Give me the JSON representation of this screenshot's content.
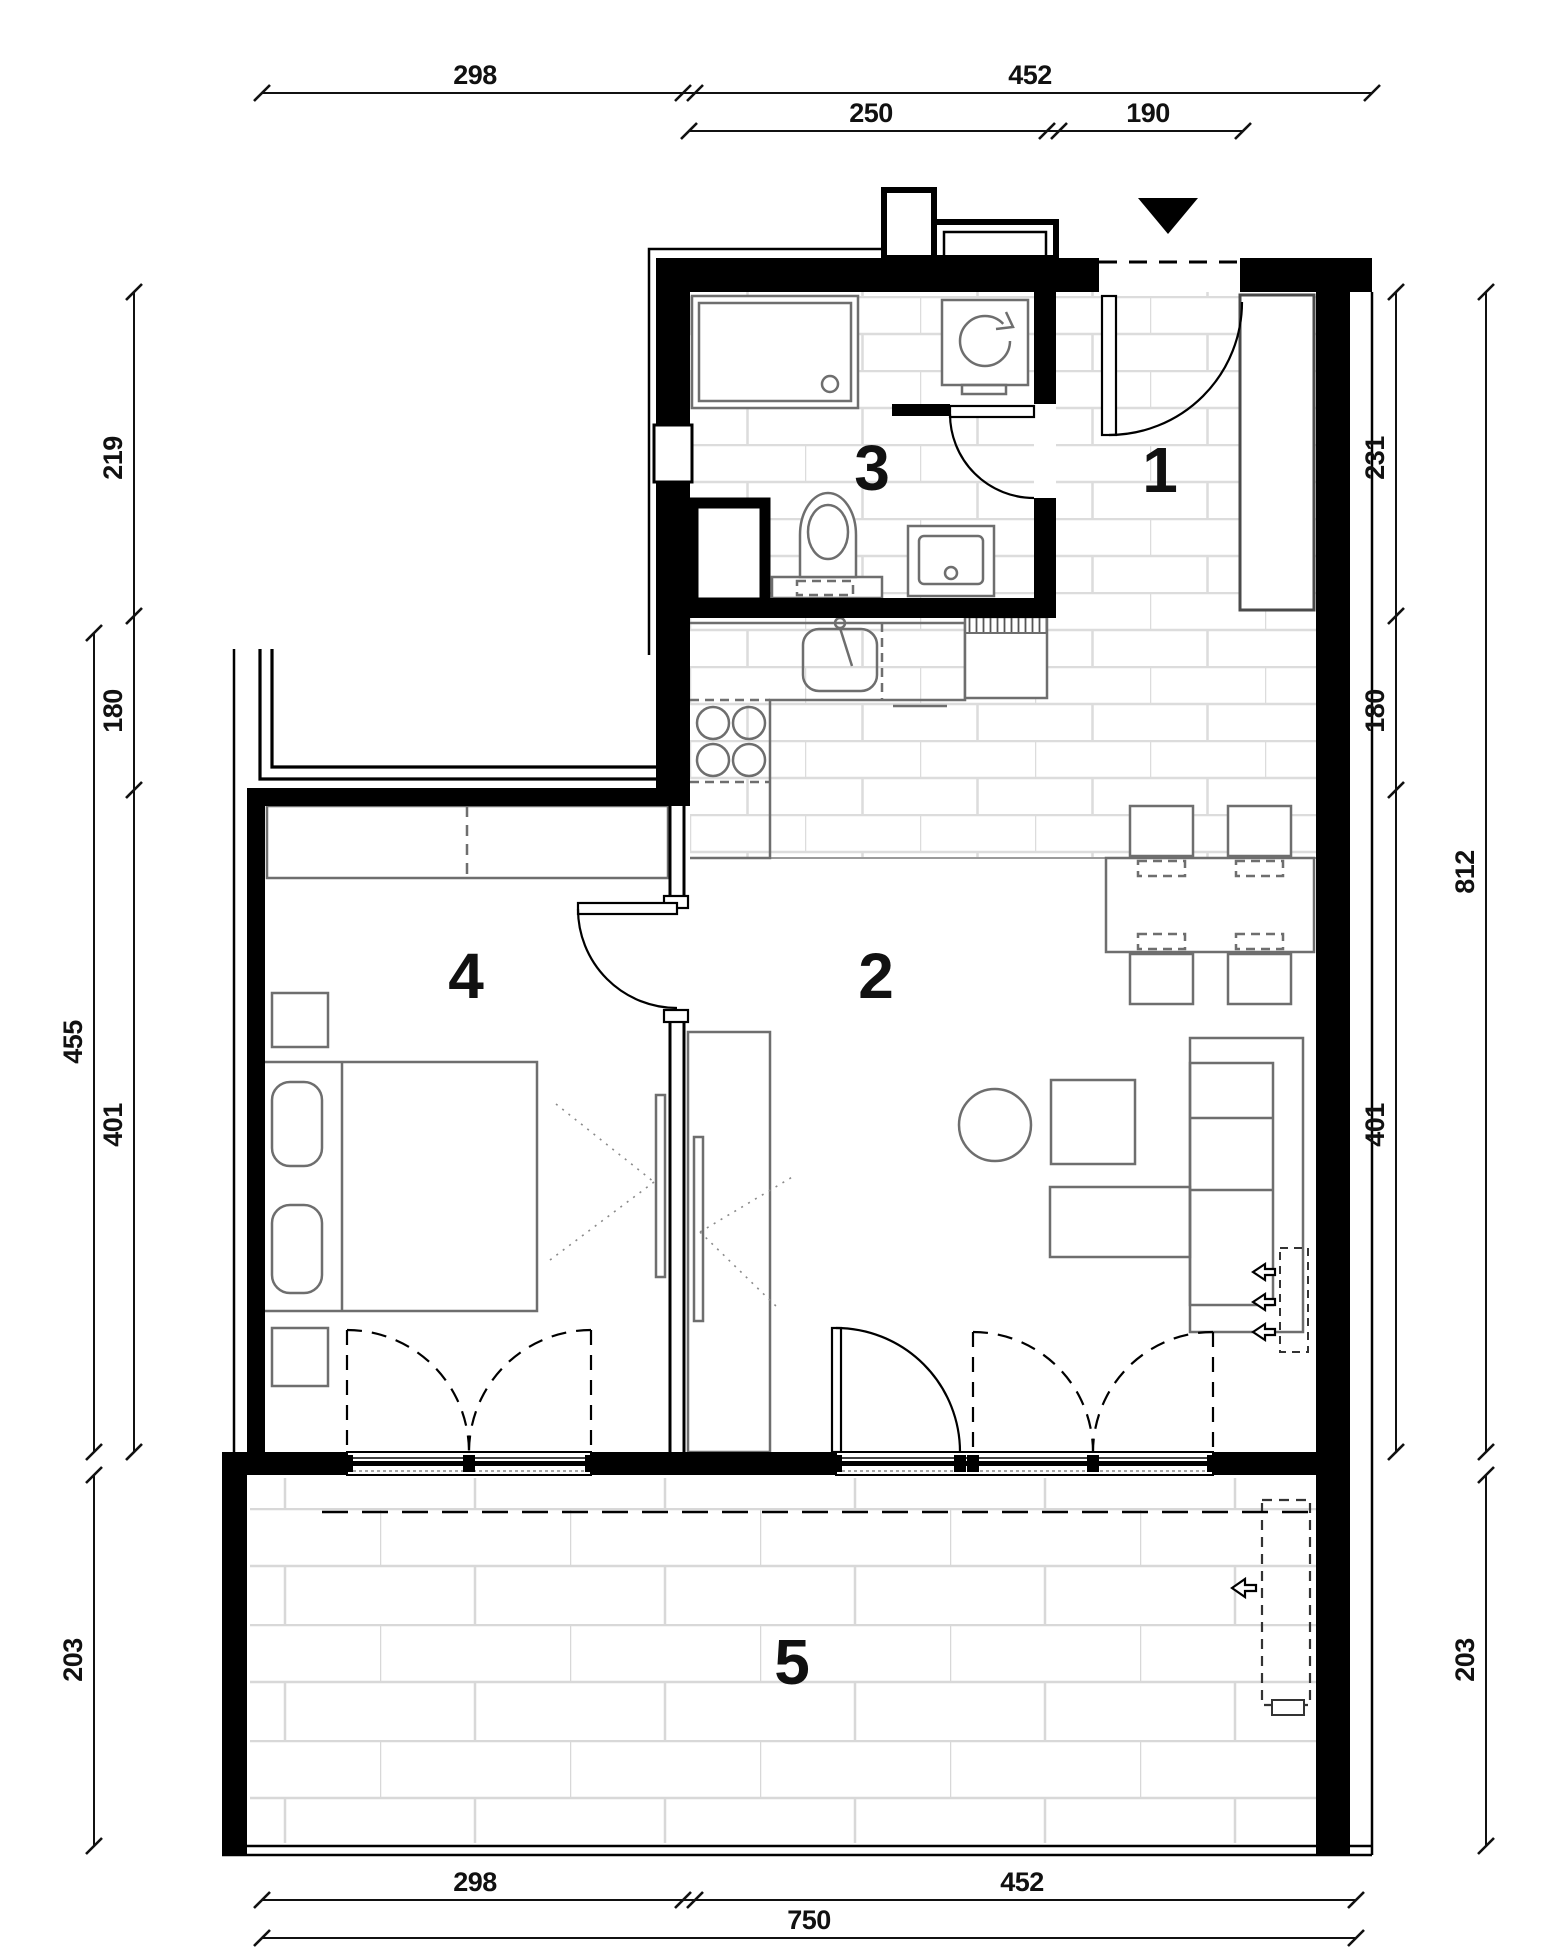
{
  "plan": {
    "type": "apartment-floor-plan",
    "floor_pattern": "brick-tile",
    "colors": {
      "wall": "#000000",
      "furniture_line": "#6e6e6e",
      "tile_joint": "#dcdcdc",
      "dimension_text": "#111111"
    }
  },
  "rooms": [
    {
      "label": "1"
    },
    {
      "label": "2"
    },
    {
      "label": "3"
    },
    {
      "label": "4"
    },
    {
      "label": "5"
    }
  ],
  "dims": {
    "top1": [
      {
        "v": "298"
      },
      {
        "v": "452"
      }
    ],
    "top2": [
      {
        "v": "250"
      },
      {
        "v": "190"
      }
    ],
    "left_inner": [
      {
        "v": "219"
      },
      {
        "v": "180"
      },
      {
        "v": "401"
      }
    ],
    "left_outer": [
      {
        "v": "455"
      },
      {
        "v": "203"
      }
    ],
    "right_inner": [
      {
        "v": "231"
      },
      {
        "v": "180"
      },
      {
        "v": "401"
      }
    ],
    "right_outer": [
      {
        "v": "812"
      },
      {
        "v": "203"
      }
    ],
    "bottom1": [
      {
        "v": "298"
      },
      {
        "v": "452"
      }
    ],
    "bottom2": [
      {
        "v": "750"
      }
    ]
  },
  "icons": {
    "entrance_marker": "filled-triangle-down",
    "washer_rotation": "circular-arrow",
    "airflow_arrow": "outline-arrow-left"
  }
}
